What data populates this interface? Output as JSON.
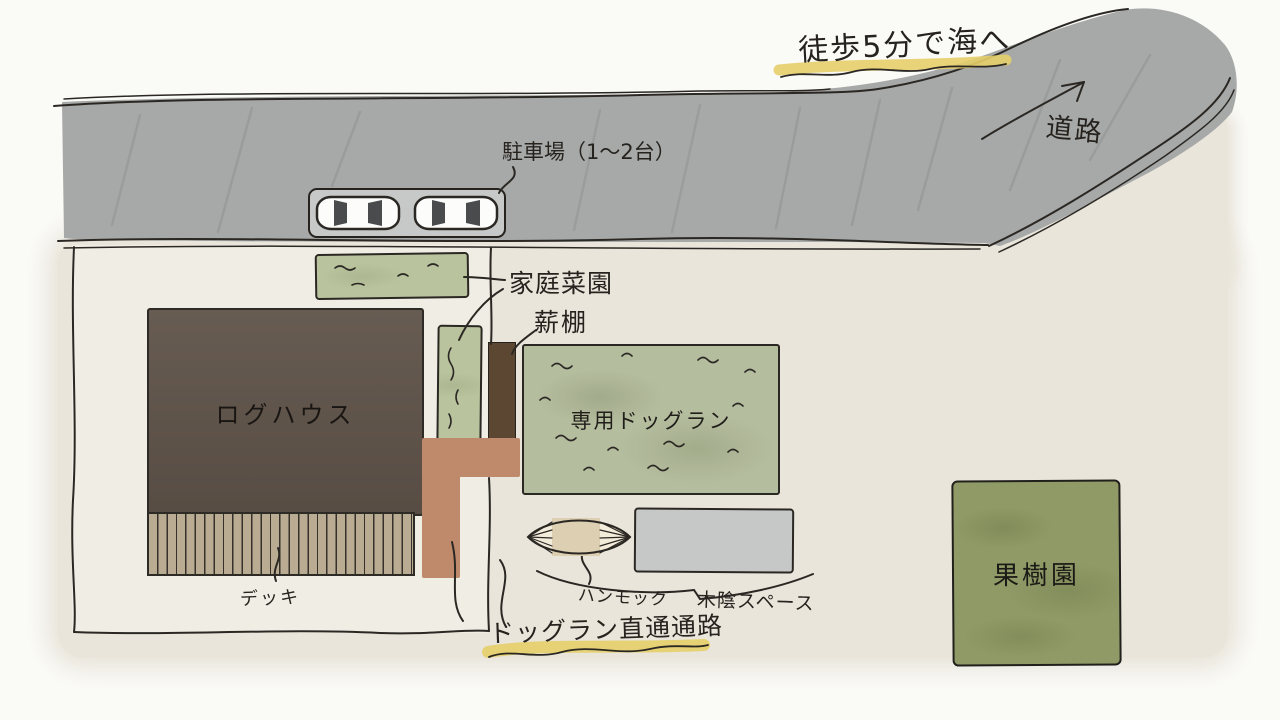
{
  "labels": {
    "sea_note": "徒歩5分で海へ",
    "road": "道路",
    "parking": "駐車場（1〜2台）",
    "vegetable_garden": "家庭菜園",
    "firewood_rack": "薪棚",
    "log_house": "ログハウス",
    "dog_run": "専用ドッグラン",
    "deck": "デッキ",
    "hammock": "ハンモック",
    "shade_space": "木陰スペース",
    "dog_run_path": "ドッグラン直通通路",
    "orchard": "果樹園"
  },
  "colors": {
    "road_gray": "#a7a9a8",
    "ground_beige": "#e9e5db",
    "yard_cream": "#f0ede4",
    "house_brown": "#5f5349",
    "deck_tan": "#b9ac93",
    "firewood_brown": "#5c4733",
    "path_terracotta": "#bf8a6c",
    "garden_green": "#b9c39e",
    "dogrun_green": "#b5bd9f",
    "orchard_green": "#8f9a67",
    "shade_gray": "#c6c8c7",
    "highlight_yellow": "#e5ce69",
    "ink_black": "#2b2824"
  }
}
